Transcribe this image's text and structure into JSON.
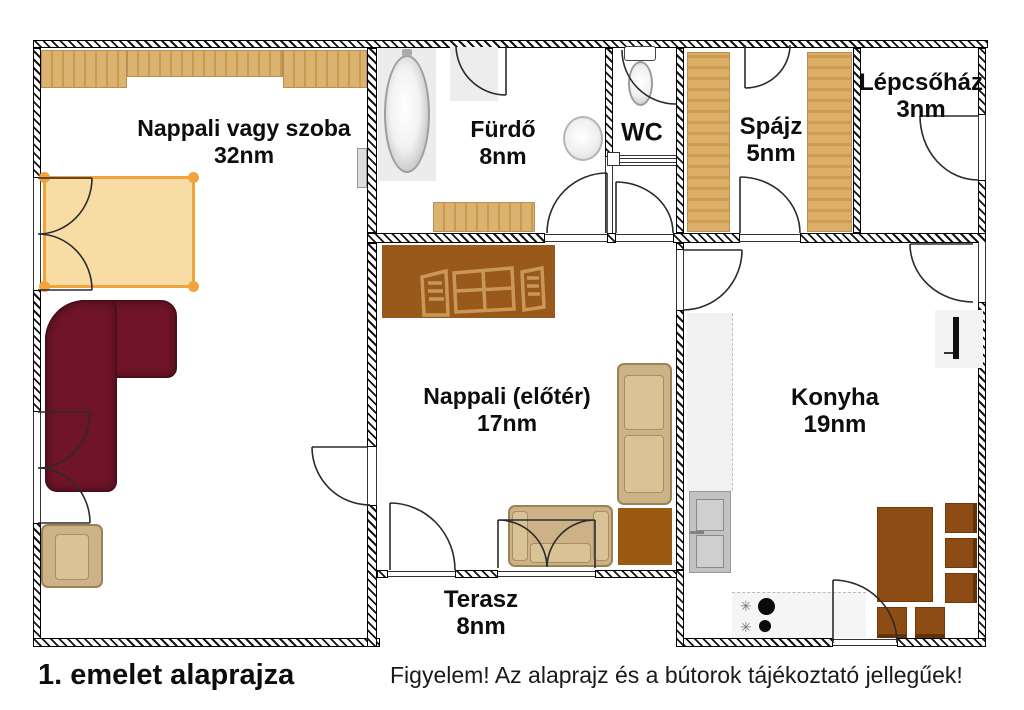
{
  "palette": {
    "wall_line": "#161616",
    "shelf_tan": "#dcb271",
    "shelf_tan_dark": "#c99b50",
    "bed_fill": "#f7d794",
    "bed_accent": "#f2a43b",
    "sofa_burgundy": "#701527",
    "fabric_tan": "#cdb187",
    "furniture_brown": "#8d4c13",
    "cabinet_brown": "#98591b",
    "counter_gray": "#f1f1f1"
  },
  "rooms": [
    {
      "name": "Nappali vagy szoba",
      "area": "32nm"
    },
    {
      "name": "Fürdő",
      "area": "8nm"
    },
    {
      "name": "WC",
      "area": ""
    },
    {
      "name": "Spájz",
      "area": "5nm"
    },
    {
      "name": "Lépcsőház",
      "area": "3nm"
    },
    {
      "name": "Nappali (előtér)",
      "area": "17nm"
    },
    {
      "name": "Konyha",
      "area": "19nm"
    },
    {
      "name": "Terasz",
      "area": "8nm"
    }
  ],
  "captions": {
    "title": "1. emelet alaprajza",
    "disclaimer": "Figyelem! Az alaprajz és a bútorok tájékoztató jellegűek!"
  },
  "icons": {
    "burner_knob": "✳"
  }
}
